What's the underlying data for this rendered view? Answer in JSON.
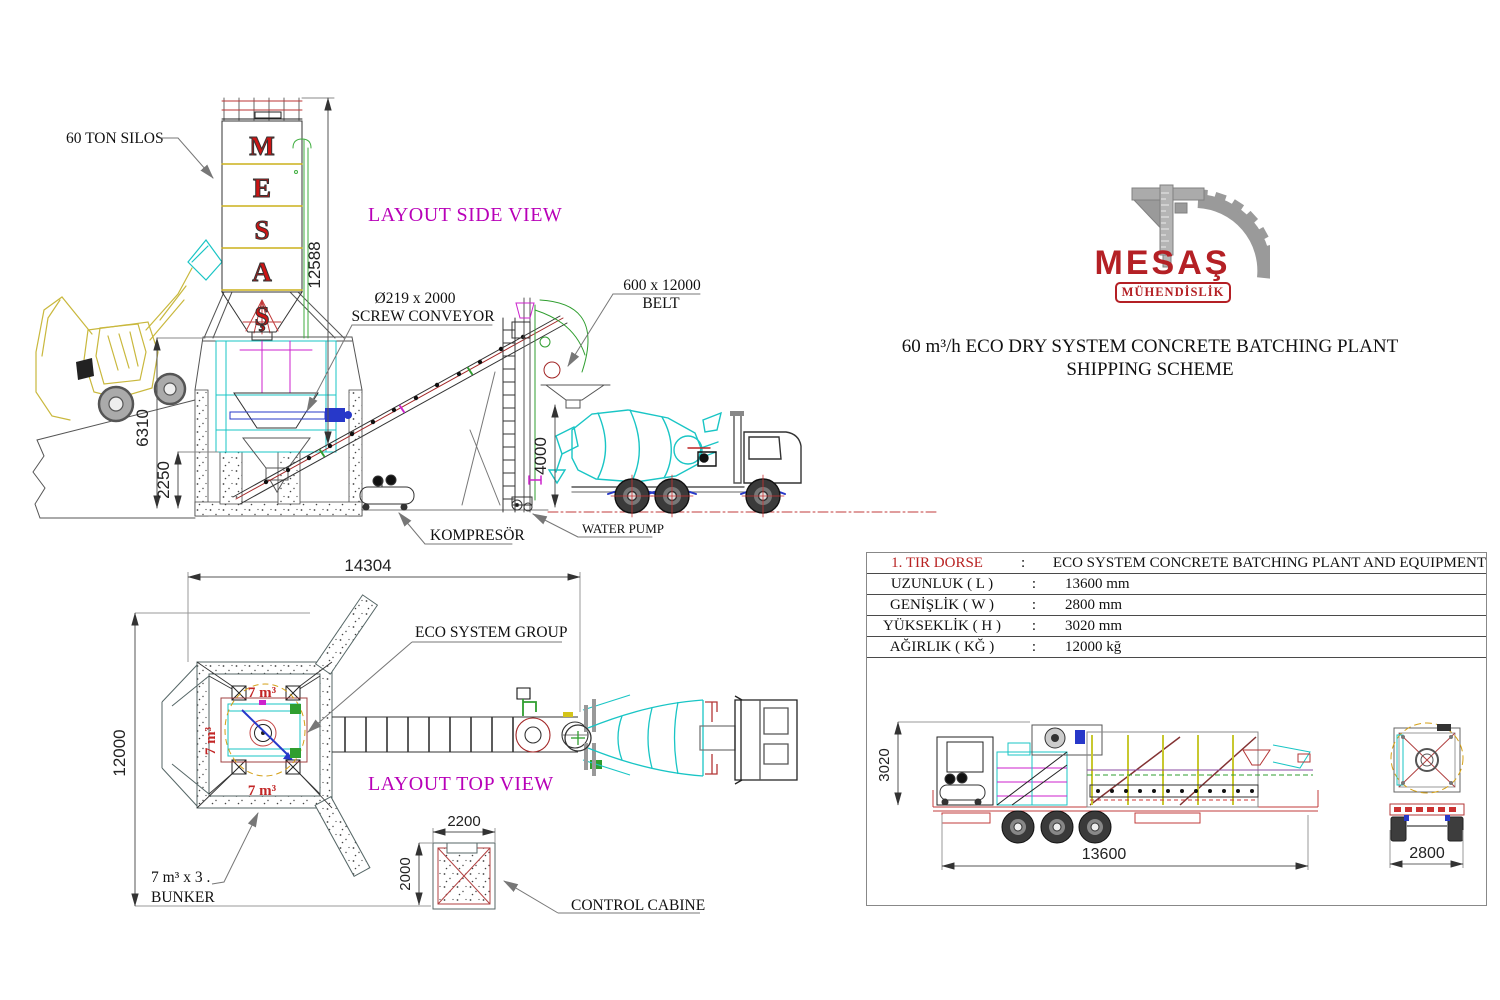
{
  "header": {
    "logo_text": "MESAŞ",
    "logo_subtitle": "MÜHENDİSLİK",
    "title_line1": "60 m³/h ECO DRY SYSTEM CONCRETE BATCHING PLANT",
    "title_line2": "SHIPPING SCHEME"
  },
  "side_view": {
    "title": "LAYOUT SIDE VIEW",
    "labels": {
      "silo": "60 TON SILOS",
      "screw_line1": "Ø219 x 2000",
      "screw_line2": "SCREW CONVEYOR",
      "belt_line1": "600 x 12000",
      "belt_line2": "BELT",
      "compressor": "KOMPRESÖR",
      "water_pump": "WATER PUMP"
    },
    "silo_letters": [
      "M",
      "E",
      "S",
      "A",
      "Ş"
    ],
    "dims": {
      "silo_height": "12588",
      "structure_height": "6310",
      "pit_depth": "2250",
      "discharge_clearance": "4000"
    }
  },
  "top_view": {
    "title": "LAYOUT TOP VIEW",
    "labels": {
      "eco_group": "ECO SYSTEM GROUP",
      "bunker_cell": "7 m³",
      "bunker_line1": "7 m³ x 3 .",
      "bunker_line2": "BUNKER",
      "control_cabin": "CONTROL CABINE"
    },
    "dims": {
      "plant_length": "14304",
      "plant_width": "12000",
      "cabin_width": "2200",
      "cabin_depth": "2000"
    }
  },
  "shipping_panel": {
    "separator": ":",
    "rows": [
      {
        "label": "1. TIR DORSE",
        "value": "ECO SYSTEM CONCRETE BATCHING PLANT AND EQUIPMENT"
      },
      {
        "label": "UZUNLUK ( L )",
        "value": "13600 mm"
      },
      {
        "label": "GENİŞLİK ( W )",
        "value": "2800 mm"
      },
      {
        "label": "YÜKSEKLİK ( H )",
        "value": "3020 mm"
      },
      {
        "label": "AĞIRLIK ( KĞ )",
        "value": "12000 kğ"
      }
    ],
    "dims": {
      "trailer_height": "3020",
      "trailer_length": "13600",
      "trailer_width": "2800"
    }
  },
  "colors": {
    "accent_magenta": "#b800b8",
    "brand_red": "#b42025",
    "cad_cyan": "#19c5c5",
    "cad_yellow": "#ccb01c",
    "dim_red": "#c23b3b"
  }
}
